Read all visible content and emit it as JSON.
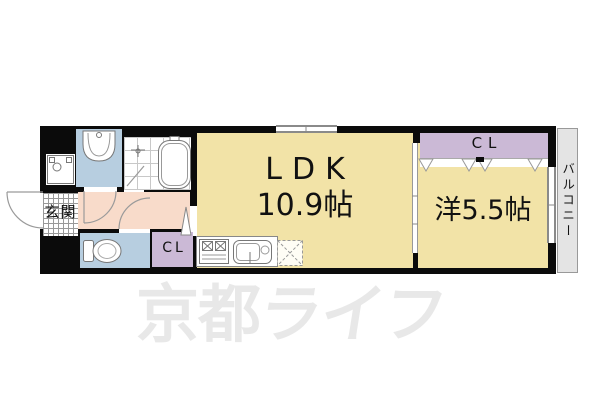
{
  "floorplan": {
    "watermark": {
      "part1": "京都",
      "part2": "ライフ"
    },
    "rooms": {
      "ldk": {
        "label": "LDK",
        "size": "10.9帖"
      },
      "western": {
        "label": "洋5.5帖"
      },
      "closet_top": {
        "label": "CL"
      },
      "closet_bottom": {
        "label": "CL"
      },
      "entrance": {
        "label": "玄関"
      },
      "balcony": {
        "label": "バルコニー"
      }
    },
    "fixtures": [
      "washing-machine",
      "washbasin",
      "bathtub",
      "toilet",
      "stove",
      "sink",
      "refrigerator"
    ],
    "colors": {
      "room_yellow": "#f2e3a7",
      "hallway_pink": "#f8dbca",
      "wet_blue": "#b7cee0",
      "closet_lavender": "#cbb9d6",
      "balcony_gray": "#e4e4e4",
      "wall_black": "#0b0b0b",
      "watermark_gray": "#e8e8e8",
      "line_gray": "#8a8a8a"
    }
  }
}
